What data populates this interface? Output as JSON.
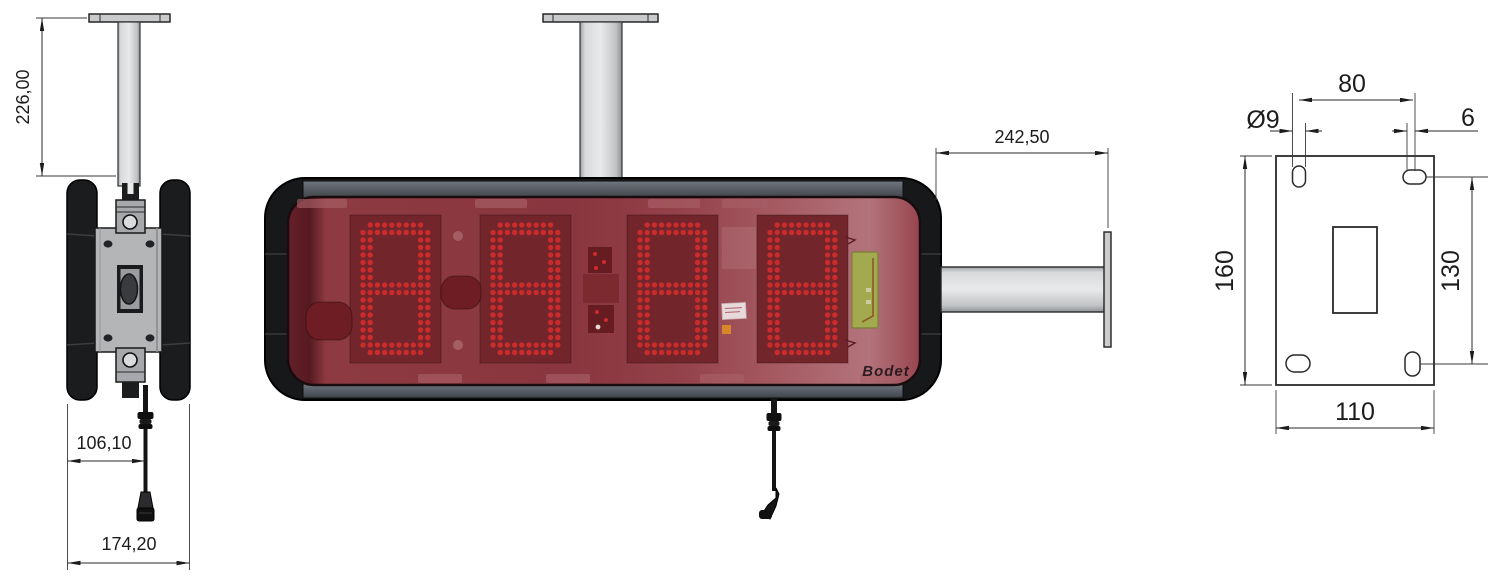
{
  "drawing": {
    "type": "technical-dimension-drawing",
    "views": [
      "side-view",
      "front-view",
      "mounting-plate-view"
    ]
  },
  "colors": {
    "led": "#cf2b2b",
    "panel_red": "#73252c",
    "window_red": "#8a3640",
    "frame_dark": "#1a1b1d",
    "metal_grey": "#c9cacc",
    "pcb_green": "#a3a94e",
    "dimension_line": "#2a2a2a"
  },
  "side_view": {
    "dim_pole_height": "226,00",
    "dim_cable_offset": "106,10",
    "dim_overall_depth": "174,20"
  },
  "front_view": {
    "dim_arm_length": "242,50",
    "brand_logo": "Bodet",
    "digits": [
      "8",
      "8",
      "8",
      "8"
    ]
  },
  "plate_view": {
    "dim_hole_spacing_horizontal": "80",
    "dim_hole_diameter": "Ø9",
    "dim_slot_width": "6",
    "dim_plate_height": "160",
    "dim_hole_spacing_vertical": "130",
    "dim_plate_width": "110"
  }
}
